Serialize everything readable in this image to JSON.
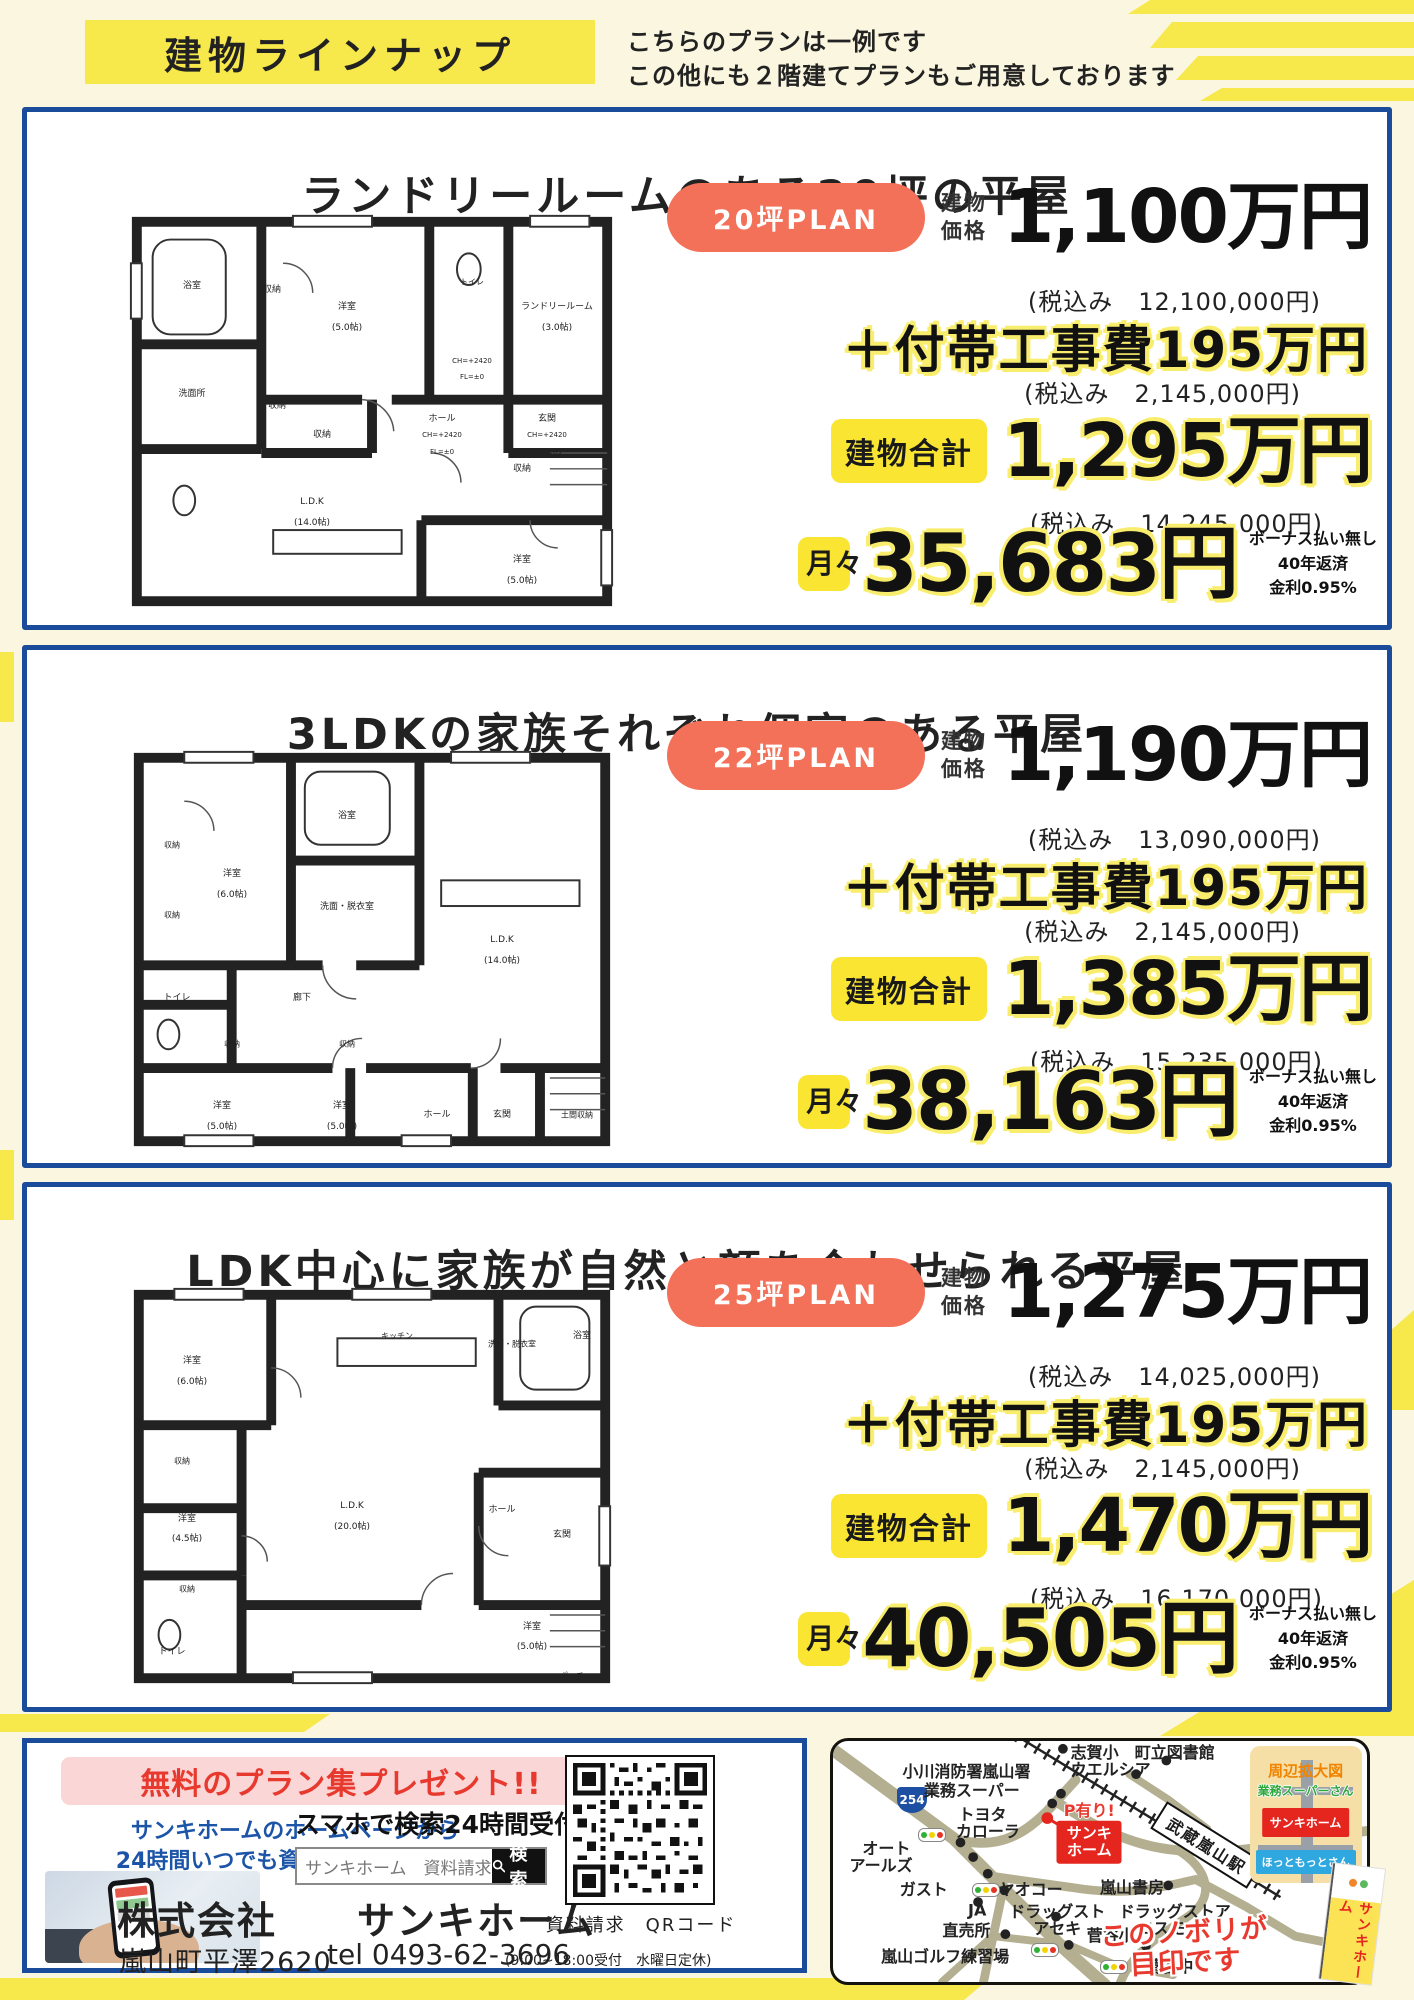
{
  "colors": {
    "accent-yellow": "#F7E84B",
    "outline-yellow": "#F9ED6E",
    "panel-border-blue": "#1B4B9B",
    "pill-salmon": "#F37059",
    "badge-yellow": "#F9E532",
    "price-red": "#E8392F",
    "link-blue": "#1C55A8",
    "map-road": "#B3AF90",
    "map-inset-bg": "#F6DFA6",
    "inset-orange": "#F08300",
    "green-label": "#2FA83C",
    "red-box": "#E5261F",
    "blue-box": "#2FA7DF"
  },
  "header": {
    "title": "建物ラインナップ",
    "note_line1": "こちらのプランは一例です",
    "note_line2": "この他にも２階建てプランもご用意しております"
  },
  "plans": [
    {
      "title": "ランドリールームのある20坪の平屋",
      "badge": "20坪PLAN",
      "price_l1": "建物",
      "price_l2": "価格",
      "price": "1,100万円",
      "price_tax": "(税込み　12,100,000円)",
      "extra": "＋付帯工事費195万円",
      "extra_tax": "(税込み　2,145,000円)",
      "total_label": "建物合計",
      "total": "1,295万円",
      "total_tax": "(税込み　14,245,000円)",
      "monthly_label": "月々",
      "monthly": "35,683円",
      "note1": "ボーナス払い無し",
      "note2": "40年返済",
      "note3": "金利0.95%",
      "rooms": [
        {
          "t": "浴室",
          "x": 14,
          "y": 20
        },
        {
          "t": "収納",
          "x": 30,
          "y": 21
        },
        {
          "t": "洋室",
          "x": 45,
          "y": 25
        },
        {
          "t": "(5.0帖)",
          "x": 45,
          "y": 30
        },
        {
          "t": "トイレ",
          "x": 70,
          "y": 19,
          "s": 8
        },
        {
          "t": "CH=+2420",
          "x": 70,
          "y": 38,
          "s": 7
        },
        {
          "t": "FL=±0",
          "x": 70,
          "y": 42,
          "s": 7
        },
        {
          "t": "ランドリールーム",
          "x": 87,
          "y": 25
        },
        {
          "t": "(3.0帖)",
          "x": 87,
          "y": 30
        },
        {
          "t": "洗面所",
          "x": 14,
          "y": 46
        },
        {
          "t": "収納",
          "x": 31,
          "y": 49
        },
        {
          "t": "ホール",
          "x": 64,
          "y": 52
        },
        {
          "t": "CH=+2420",
          "x": 64,
          "y": 56,
          "s": 7
        },
        {
          "t": "FL=±0",
          "x": 64,
          "y": 60,
          "s": 7
        },
        {
          "t": "玄関",
          "x": 85,
          "y": 52
        },
        {
          "t": "CH=+2420",
          "x": 85,
          "y": 56,
          "s": 7
        },
        {
          "t": "FL=-185",
          "x": 85,
          "y": 60,
          "s": 7
        },
        {
          "t": "収納",
          "x": 40,
          "y": 56
        },
        {
          "t": "L.D.K",
          "x": 38,
          "y": 72
        },
        {
          "t": "(14.0帖)",
          "x": 38,
          "y": 77
        },
        {
          "t": "収納",
          "x": 80,
          "y": 64
        },
        {
          "t": "洋室",
          "x": 80,
          "y": 86
        },
        {
          "t": "(5.0帖)",
          "x": 80,
          "y": 91
        }
      ]
    },
    {
      "title": "3LDKの家族それぞれ個室のある平屋",
      "badge": "22坪PLAN",
      "price_l1": "建物",
      "price_l2": "価格",
      "price": "1,190万円",
      "price_tax": "(税込み　13,090,000円)",
      "extra": "＋付帯工事費195万円",
      "extra_tax": "(税込み　2,145,000円)",
      "total_label": "建物合計",
      "total": "1,385万円",
      "total_tax": "(税込み　15,235,000円)",
      "monthly_label": "月々",
      "monthly": "38,163円",
      "note1": "ボーナス払い無し",
      "note2": "40年返済",
      "note3": "金利0.95%",
      "rooms": [
        {
          "t": "収納",
          "x": 10,
          "y": 25,
          "s": 8
        },
        {
          "t": "洋室",
          "x": 22,
          "y": 32
        },
        {
          "t": "(6.0帖)",
          "x": 22,
          "y": 37
        },
        {
          "t": "浴室",
          "x": 45,
          "y": 18
        },
        {
          "t": "洗面・脱衣室",
          "x": 45,
          "y": 40
        },
        {
          "t": "L.D.K",
          "x": 76,
          "y": 48
        },
        {
          "t": "(14.0帖)",
          "x": 76,
          "y": 53
        },
        {
          "t": "収納",
          "x": 10,
          "y": 42,
          "s": 8
        },
        {
          "t": "トイレ",
          "x": 11,
          "y": 62
        },
        {
          "t": "廊下",
          "x": 36,
          "y": 62
        },
        {
          "t": "収納",
          "x": 22,
          "y": 73,
          "s": 8
        },
        {
          "t": "収納",
          "x": 45,
          "y": 73,
          "s": 8
        },
        {
          "t": "洋室",
          "x": 20,
          "y": 88
        },
        {
          "t": "(5.0帖)",
          "x": 20,
          "y": 93
        },
        {
          "t": "洋室",
          "x": 44,
          "y": 88
        },
        {
          "t": "(5.0帖)",
          "x": 44,
          "y": 93
        },
        {
          "t": "ホール",
          "x": 63,
          "y": 90
        },
        {
          "t": "玄関",
          "x": 76,
          "y": 90
        },
        {
          "t": "土間収納",
          "x": 91,
          "y": 90,
          "s": 8
        }
      ]
    },
    {
      "title": "LDK中心に家族が自然と顔を合わせられる平屋",
      "badge": "25坪PLAN",
      "price_l1": "建物",
      "price_l2": "価格",
      "price": "1,275万円",
      "price_tax": "(税込み　14,025,000円)",
      "extra": "＋付帯工事費195万円",
      "extra_tax": "(税込み　2,145,000円)",
      "total_label": "建物合計",
      "total": "1,470万円",
      "total_tax": "(税込み　16,170,000円)",
      "monthly_label": "月々",
      "monthly": "40,505円",
      "note1": "ボーナス払い無し",
      "note2": "40年返済",
      "note3": "金利0.95%",
      "rooms": [
        {
          "t": "洋室",
          "x": 14,
          "y": 20
        },
        {
          "t": "(6.0帖)",
          "x": 14,
          "y": 25
        },
        {
          "t": "キッチン",
          "x": 55,
          "y": 14,
          "s": 8
        },
        {
          "t": "洗面・脱衣室",
          "x": 78,
          "y": 16,
          "s": 8
        },
        {
          "t": "浴室",
          "x": 92,
          "y": 14
        },
        {
          "t": "収納",
          "x": 12,
          "y": 44,
          "s": 8
        },
        {
          "t": "L.D.K",
          "x": 46,
          "y": 55
        },
        {
          "t": "(20.0帖)",
          "x": 46,
          "y": 60
        },
        {
          "t": "洋室",
          "x": 13,
          "y": 58
        },
        {
          "t": "(4.5帖)",
          "x": 13,
          "y": 63
        },
        {
          "t": "収納",
          "x": 13,
          "y": 75,
          "s": 8
        },
        {
          "t": "トイレ",
          "x": 10,
          "y": 90
        },
        {
          "t": "ホール",
          "x": 76,
          "y": 56
        },
        {
          "t": "玄関",
          "x": 88,
          "y": 62
        },
        {
          "t": "洋室",
          "x": 82,
          "y": 84
        },
        {
          "t": "(5.0帖)",
          "x": 82,
          "y": 89
        },
        {
          "t": "ポーチ",
          "x": 90,
          "y": 96,
          "s": 8
        }
      ]
    }
  ],
  "footer": {
    "present": "無料のプラン集プレゼント!!",
    "hp1": "サンキホームのホームページから",
    "hp2": "24時間いつでも資料請求できます。",
    "search_caption": "スマホで検索24時間受付",
    "search_text": "サンキホーム　資料請求",
    "search_button": "検索",
    "company": "株式会社　　サンキホーム",
    "address": "嵐山町平澤2620",
    "tel": "tel 0493-62-3696",
    "tel_note": "(9:00~18:00受付　水曜日定休)",
    "qr_caption": "資料請求　QRコード"
  },
  "map": {
    "station": "武蔵嵐山駅",
    "route_shield": "254",
    "office_parking": "P有り!",
    "office_l1": "サンキ",
    "office_l2": "ホーム",
    "callout_l1": "このノボリが",
    "callout_l2": "目印です",
    "inset_title": "周辺拡大図",
    "inset_green": "業務スーパーさん",
    "inset_red": "サンキホーム",
    "inset_blue": "ほっともっとさん",
    "flag_text": "サンキホーム",
    "labels": [
      {
        "t": "小川消防署嵐山署",
        "x": 25,
        "y": 12
      },
      {
        "t": "業務スーパー",
        "x": 26,
        "y": 20
      },
      {
        "t": "トヨタ",
        "x": 28,
        "y": 30
      },
      {
        "t": "カローラ",
        "x": 29,
        "y": 37
      },
      {
        "t": "オート",
        "x": 10,
        "y": 44
      },
      {
        "t": "アールズ",
        "x": 9,
        "y": 51
      },
      {
        "t": "ガスト",
        "x": 17,
        "y": 61
      },
      {
        "t": "ヤオコー",
        "x": 37,
        "y": 61
      },
      {
        "t": "JA",
        "x": 27,
        "y": 70
      },
      {
        "t": "直売所",
        "x": 25,
        "y": 78
      },
      {
        "t": "ドラッグスト",
        "x": 42,
        "y": 70
      },
      {
        "t": "アセキ",
        "x": 42,
        "y": 77
      },
      {
        "t": "嵐山ゴルフ練習場",
        "x": 21,
        "y": 89
      },
      {
        "t": "志賀小",
        "x": 49,
        "y": 4
      },
      {
        "t": "町立図書館",
        "x": 64,
        "y": 4
      },
      {
        "t": "ウエルシア",
        "x": 52,
        "y": 11
      },
      {
        "t": "嵐山書房",
        "x": 56,
        "y": 60
      },
      {
        "t": "ドラッグストア",
        "x": 64,
        "y": 70
      },
      {
        "t": "コスモス",
        "x": 63,
        "y": 77
      },
      {
        "t": "菅谷小",
        "x": 52,
        "y": 80
      },
      {
        "t": "菅谷中",
        "x": 63,
        "y": 93
      }
    ]
  }
}
